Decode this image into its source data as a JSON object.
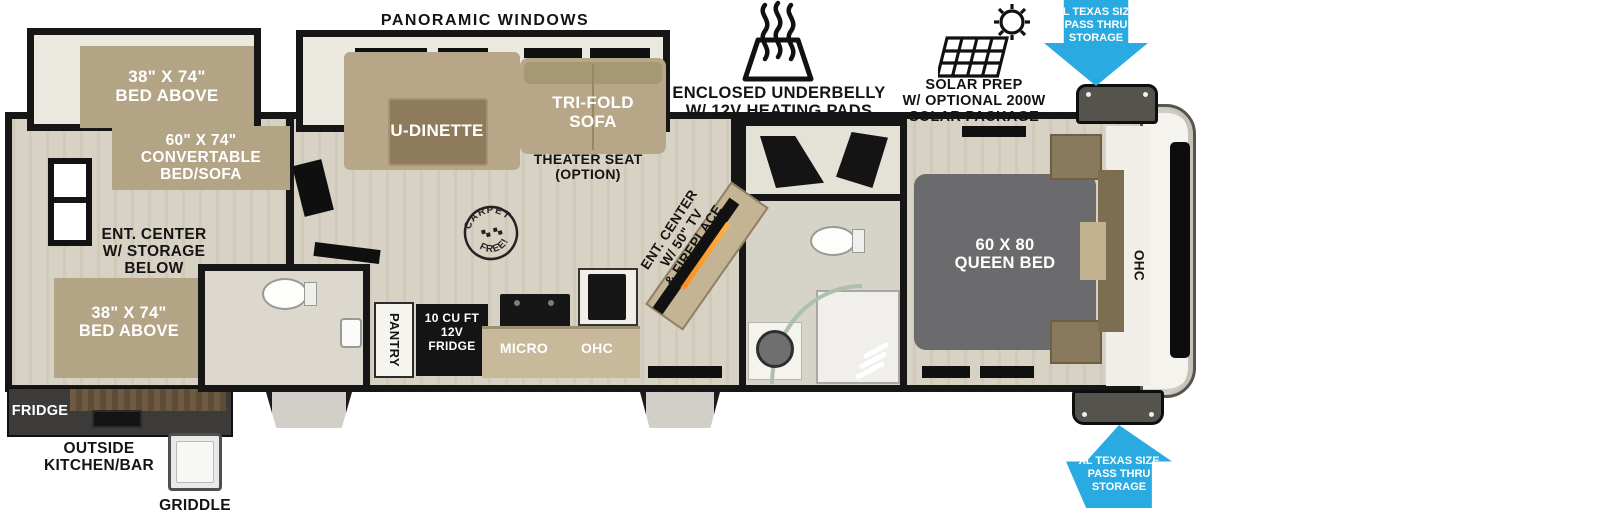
{
  "colors": {
    "accent_blue": "#29abe2",
    "wall_black": "#161616",
    "furniture_tan": "#b4a486",
    "floor_beige": "#d8d2c4",
    "bed_gray": "#6b6b6e"
  },
  "callouts": {
    "panoramic_windows": "PANORAMIC WINDOWS",
    "underbelly": {
      "line1": "ENCLOSED UNDERBELLY",
      "line2": "W/ 12V HEATING PADS"
    },
    "solar": {
      "line1": "SOLAR PREP",
      "line2": "W/ OPTIONAL 200W",
      "line3": "SOLAR PACKAGE"
    },
    "pass_thru_top": {
      "line1": "XL TEXAS SIZE",
      "line2": "PASS THRU",
      "line3": "STORAGE"
    },
    "pass_thru_bottom": {
      "line1": "XL TEXAS SIZE",
      "line2": "PASS THRU",
      "line3": "STORAGE"
    },
    "carpet_free": {
      "top": "CARPET",
      "bottom": "FREE!"
    }
  },
  "bunk_room": {
    "bunk_top_line1": "38\" X 74\"",
    "bunk_top_line2": "BED ABOVE",
    "convertible_line1": "60\" X 74\"",
    "convertible_line2": "CONVERTABLE",
    "convertible_line3": "BED/SOFA",
    "ent_center_line1": "ENT. CENTER",
    "ent_center_line2": "W/ STORAGE",
    "ent_center_line3": "BELOW",
    "bunk_bottom_line1": "38\" X 74\"",
    "bunk_bottom_line2": "BED ABOVE"
  },
  "living_area": {
    "u_dinette": "U-DINETTE",
    "tri_fold_line1": "TRI-FOLD",
    "tri_fold_line2": "SOFA",
    "theater_line1": "THEATER SEAT",
    "theater_line2": "(OPTION)",
    "ent_center_line1": "ENT. CENTER",
    "ent_center_line2": "W/ 50\" TV",
    "ent_center_line3": "& FIREPLACE"
  },
  "kitchen": {
    "pantry": "PANTRY",
    "fridge_line1": "10 CU FT",
    "fridge_line2": "12V",
    "fridge_line3": "FRIDGE",
    "micro": "MICRO",
    "ohc": "OHC"
  },
  "bedroom": {
    "bed_line1": "60 X 80",
    "bed_line2": "QUEEN BED",
    "ohc": "OHC"
  },
  "exterior_rear": {
    "fridge": "FRIDGE",
    "outside_line1": "OUTSIDE",
    "outside_line2": "KITCHEN/BAR",
    "griddle": "GRIDDLE"
  }
}
